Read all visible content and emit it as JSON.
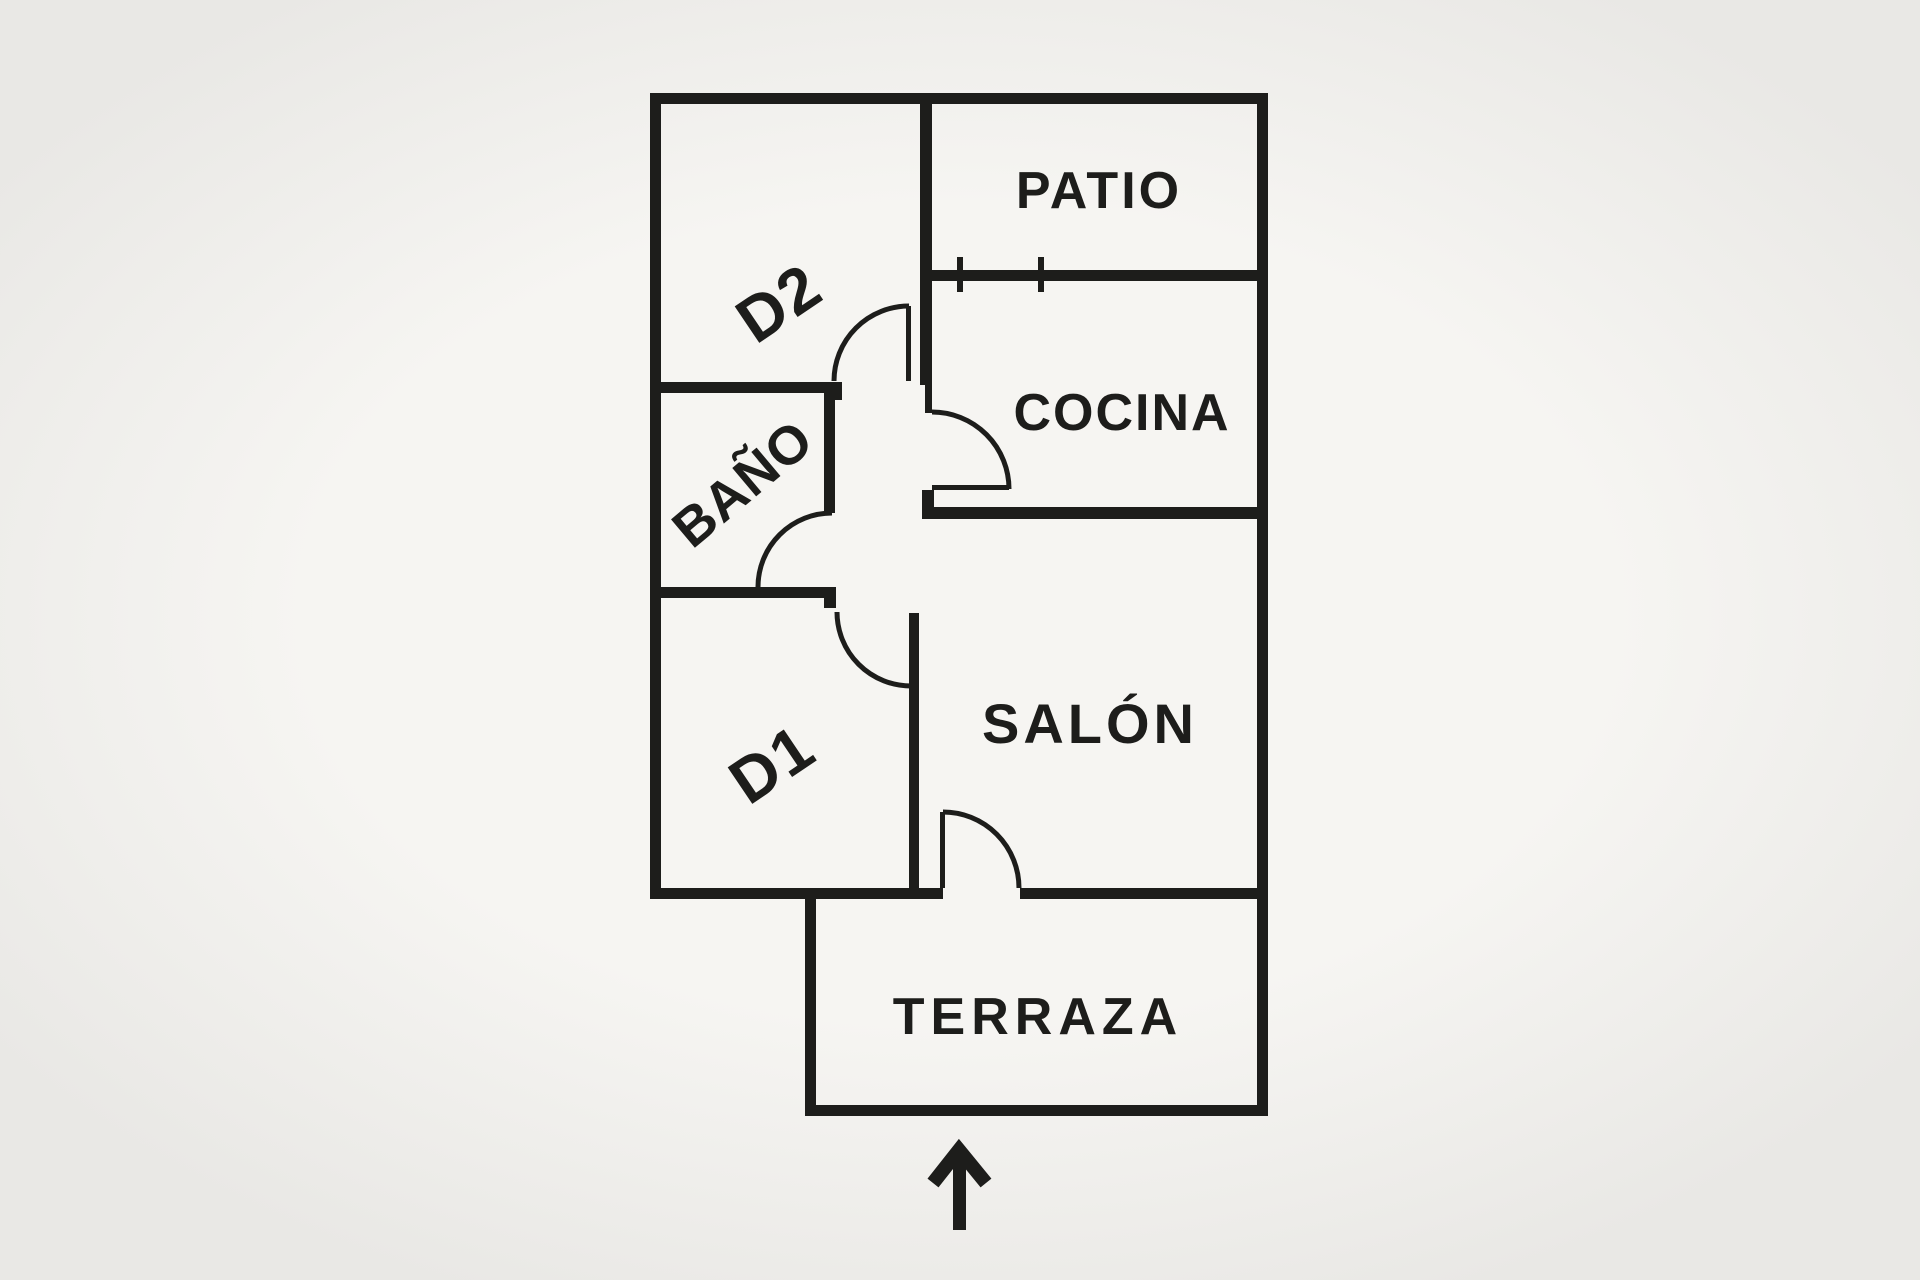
{
  "plan": {
    "type": "apartment-floor-plan",
    "rooms": {
      "patio": {
        "label": "PATIO"
      },
      "d2": {
        "label": "D2"
      },
      "cocina": {
        "label": "COCINA"
      },
      "bano": {
        "label": "BAÑO"
      },
      "d1": {
        "label": "D1"
      },
      "salon": {
        "label": "SALÓN"
      },
      "terraza": {
        "label": "TERRAZA"
      }
    },
    "features": {
      "doors": [
        "d2-door",
        "cocina-door",
        "bano-door",
        "d1-door",
        "terraza-door"
      ],
      "window": "patio-window",
      "orientation_arrow": "up-arrow"
    }
  },
  "colors": {
    "ink": "#1d1d1b",
    "paper": "#f6f5f2",
    "paper-edge": "#e9e8e5"
  }
}
